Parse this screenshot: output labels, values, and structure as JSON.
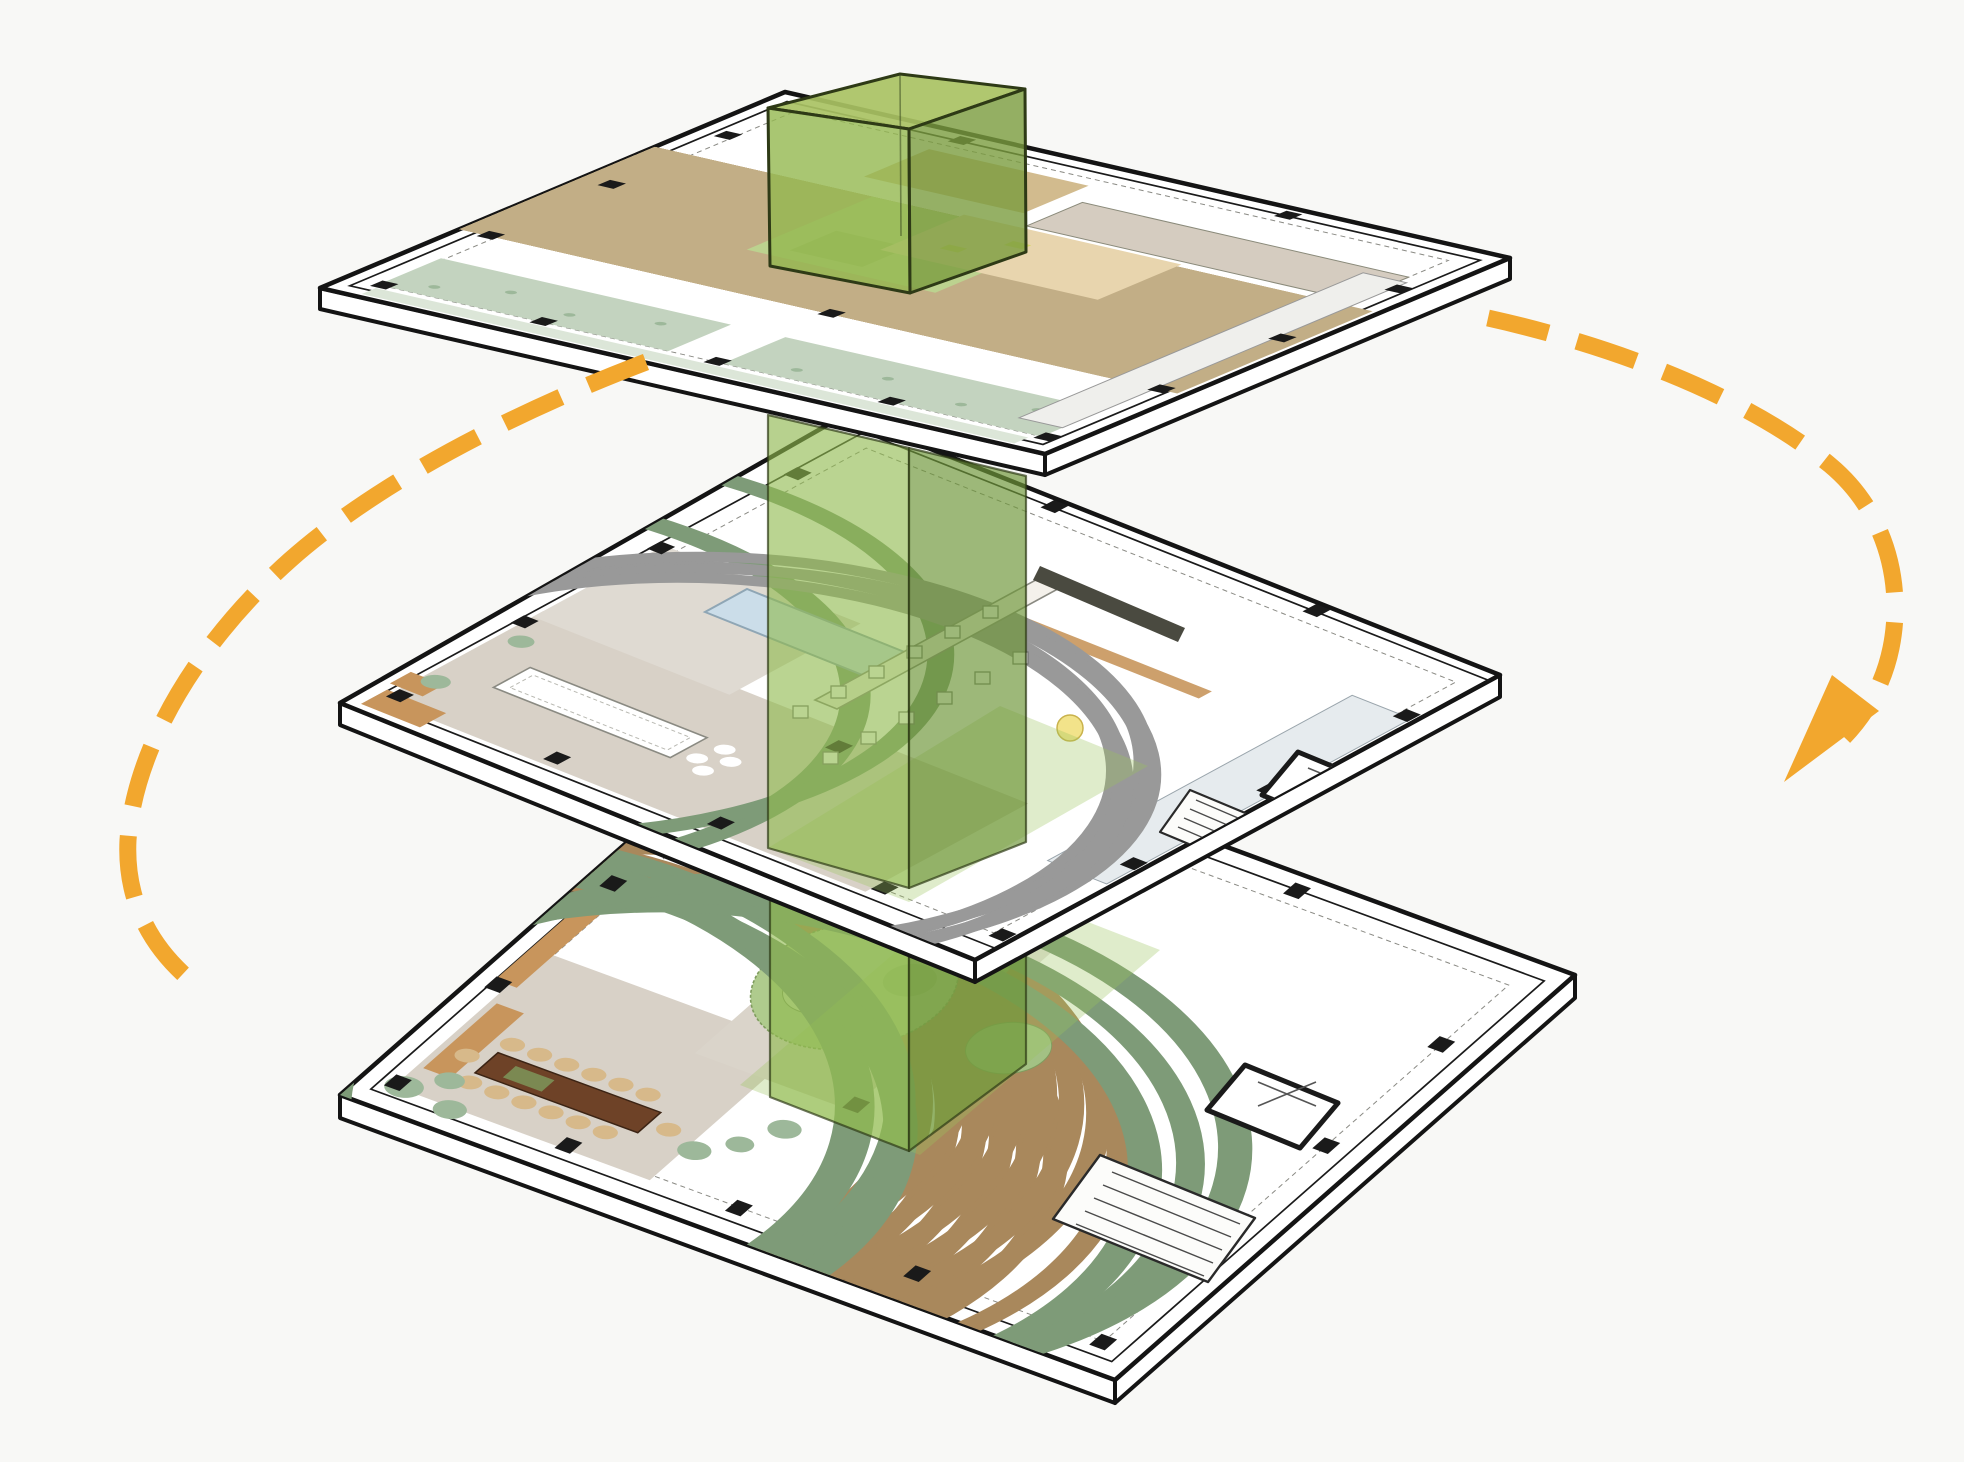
{
  "diagram": {
    "kind": "exploded-axonometric-stacked-floor-plans",
    "floor_count": 3,
    "floors": [
      {
        "id": "top-floor-plan",
        "position": "top"
      },
      {
        "id": "middle-floor-plan",
        "position": "middle"
      },
      {
        "id": "bottom-floor-plan",
        "position": "bottom"
      }
    ],
    "green_volume": {
      "id": "atrium-void-volume",
      "pieces": [
        "cube-above-roof",
        "shaft-upper",
        "shaft-lower",
        "footprint-middle",
        "footprint-bottom"
      ]
    }
  },
  "colors": {
    "background": "#F8F8F6",
    "slab_fill": "#FFFFFF",
    "outline": "#141414",
    "inner_line": "#2a2a2a",
    "dashed_line": "#8a8a84",
    "sage": "#C3D3BF",
    "sage_dark": "#9DB89A",
    "deck_beige": "#D9C9A7",
    "deck_hatch": "#C2AE86",
    "tan_room": "#D2BB8E",
    "peach": "#E8D5AE",
    "wood": "#C8955C",
    "greige": "#D8D1C7",
    "greige_dark": "#D5CCC0",
    "pool_blue": "#CBDDE9",
    "pool_edge": "#8FA6B5",
    "table_brown": "#6E4227",
    "table_brown_edge": "#3C2414",
    "stool_tan": "#D7B98A",
    "stool_edge": "#A9885C",
    "garden_green": "#AFCB8D",
    "garden_edge": "#7F9C5E",
    "garden_light": "#C6D9A6",
    "lamp_yellow": "#F2E38A",
    "column_black": "#1A1A1A",
    "wall_gray": "#8A8A88",
    "room_pale": "#E6EBEE",
    "glass_top": "#A9C263",
    "glass_left": "#93B84F",
    "glass_right": "#7A9C3E",
    "sheet_green": "#8FBA4D",
    "sheet_green_dark": "#6F963A",
    "footprint_green": "#9CC45E",
    "glass_edge": "#2E3A16"
  },
  "arrows": {
    "color": "#F2A72E",
    "dash": "62 30",
    "width": "17",
    "left": {
      "path": "M 646 362 C 520 410, 380 480, 290 560 C 200 640, 135 745, 128 840 C 125 900, 150 950, 200 988"
    },
    "right": {
      "path": "M 1488 318 C 1610 345, 1745 395, 1830 465 C 1890 515, 1903 590, 1891 648 C 1884 682, 1868 712, 1844 737",
      "arrowhead_points": "1784,782 1832,675 1879,711"
    }
  },
  "opacities": {
    "glass_top": "0.92",
    "glass_side": "0.80",
    "sheet": "0.62",
    "sheet_dark": "0.68",
    "footprint": "0.32"
  }
}
